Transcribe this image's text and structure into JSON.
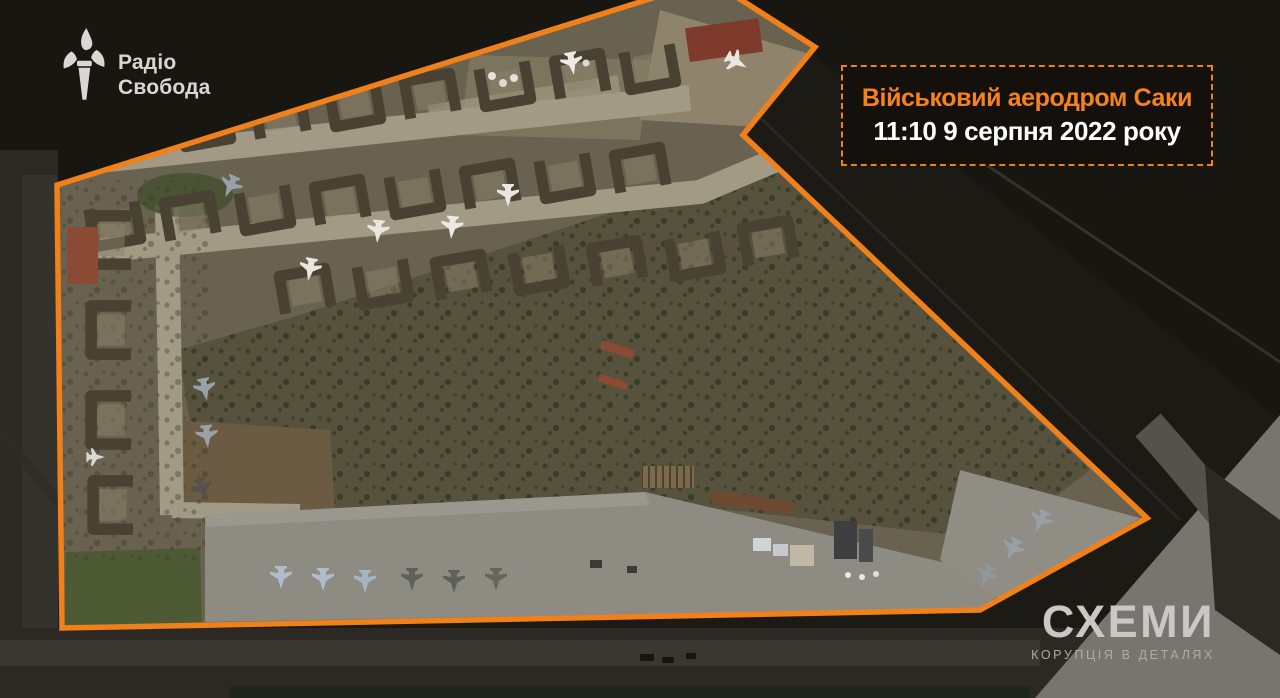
{
  "branding": {
    "radio_svoboda": {
      "icon": "torch-icon",
      "line1": "Радіо",
      "line2": "Свобода"
    },
    "skhemy": {
      "title": "СХЕМИ",
      "tagline": "КОРУПЦІЯ В ДЕТАЛЯХ"
    }
  },
  "annotation": {
    "title": "Військовий аеродром Саки",
    "timestamp": "11:10 9 серпня 2022 року"
  },
  "colors": {
    "accent_orange": "#F08019",
    "label_bg": "#14110D",
    "label_title": "#F5821F",
    "label_timestamp": "#FFFFFF",
    "logo_gray": "#D8D7D3",
    "skhemy_gray": "#CAC8C4",
    "skhemy_tagline_gray": "#AEABA7"
  }
}
